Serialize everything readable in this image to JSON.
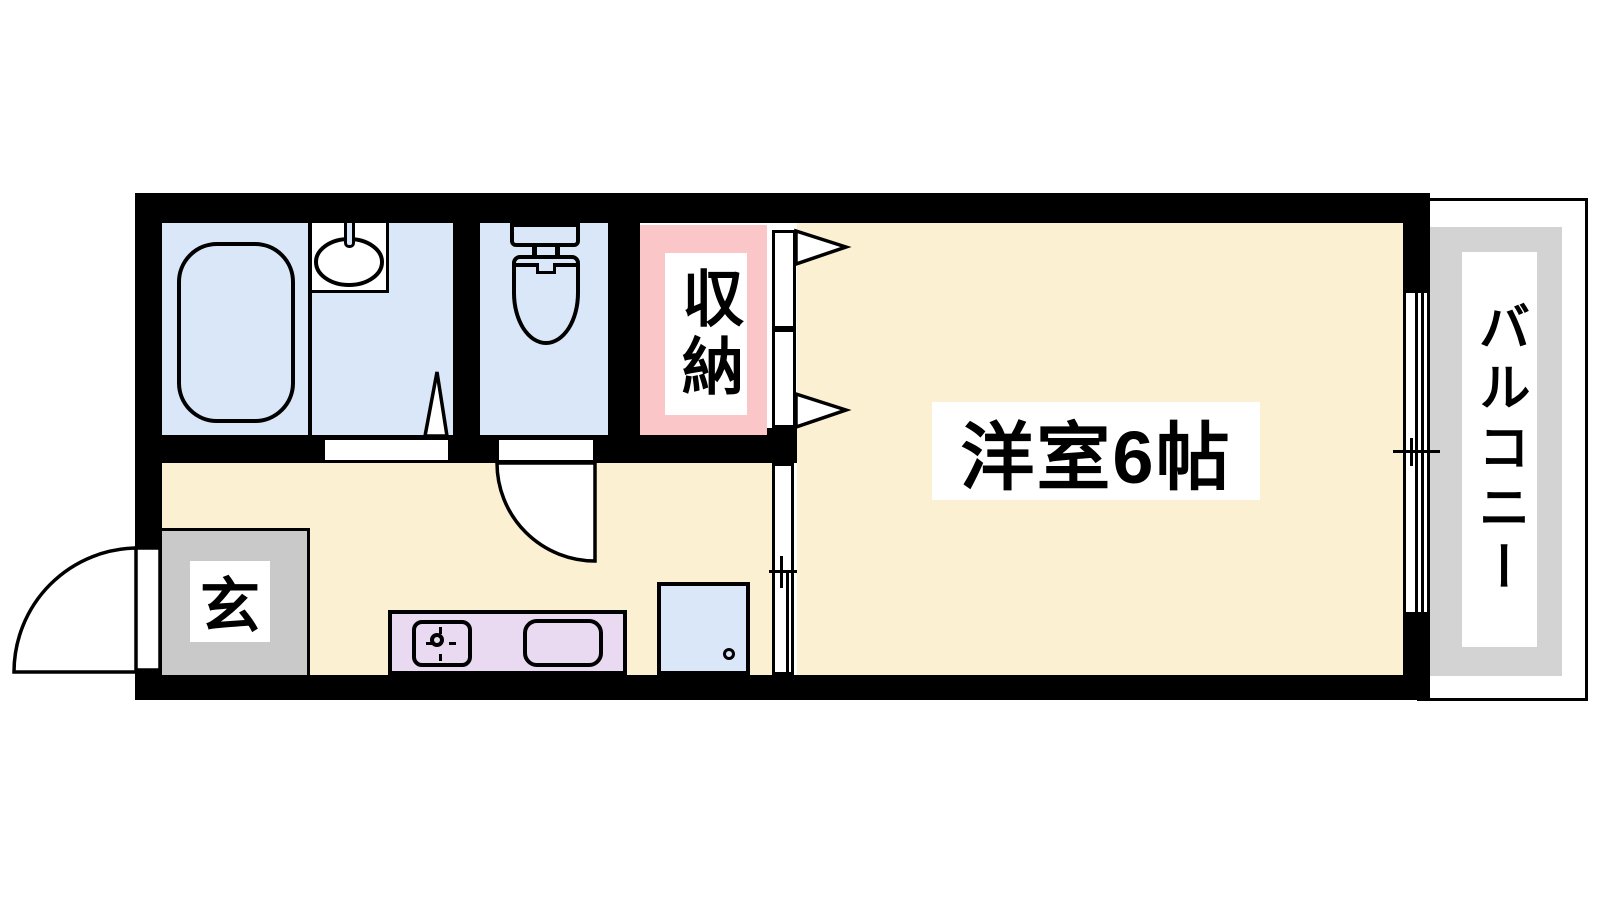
{
  "floorplan": {
    "labels": {
      "main_room": "洋室6帖",
      "closet": "収納",
      "entrance": "玄",
      "balcony": "バルコニー"
    },
    "fixtures": {
      "bathtub": "bathtub",
      "washbasin": "washbasin-with-tap",
      "toilet": "toilet-with-tank",
      "stove": "gas-stove-burner",
      "kitchen_sink": "kitchen-sink",
      "washing_machine": "washing-machine-space",
      "doors": "swing-and-sliding-doors",
      "window": "sliding-window"
    },
    "colors": {
      "page-bg": "#ffffff",
      "wall": "#000000",
      "floor-cream": "#fcf0d2",
      "floor-blue": "#d9e7f8",
      "floor-pink": "#fac6c8",
      "floor-lavender": "#e9d9f1",
      "floor-gray": "#c9c9c9",
      "balcony-gray": "#d3d3d3"
    }
  }
}
